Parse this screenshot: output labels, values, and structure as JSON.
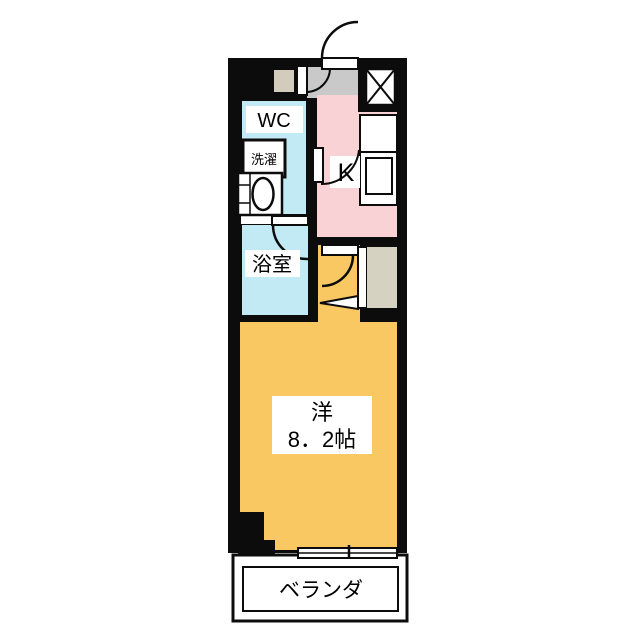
{
  "floor_plan": {
    "kind": "apartment-floor-plan",
    "labels": {
      "wc": "WC",
      "laundry": "洗濯",
      "bathroom": "浴室",
      "kitchen": "K",
      "main_room_name": "洋",
      "main_room_size": "8．2帖",
      "balcony": "ベランダ"
    },
    "colors": {
      "wall": "#0c0c0c",
      "wet_area": "#c2eaf4",
      "kitchen": "#f8d2d4",
      "main_room": "#fac863",
      "entry": "#c9c9c9",
      "shoe_box": "#d3ccbc",
      "closet": "#d5d2c2",
      "fixture": "#ffffff"
    }
  }
}
